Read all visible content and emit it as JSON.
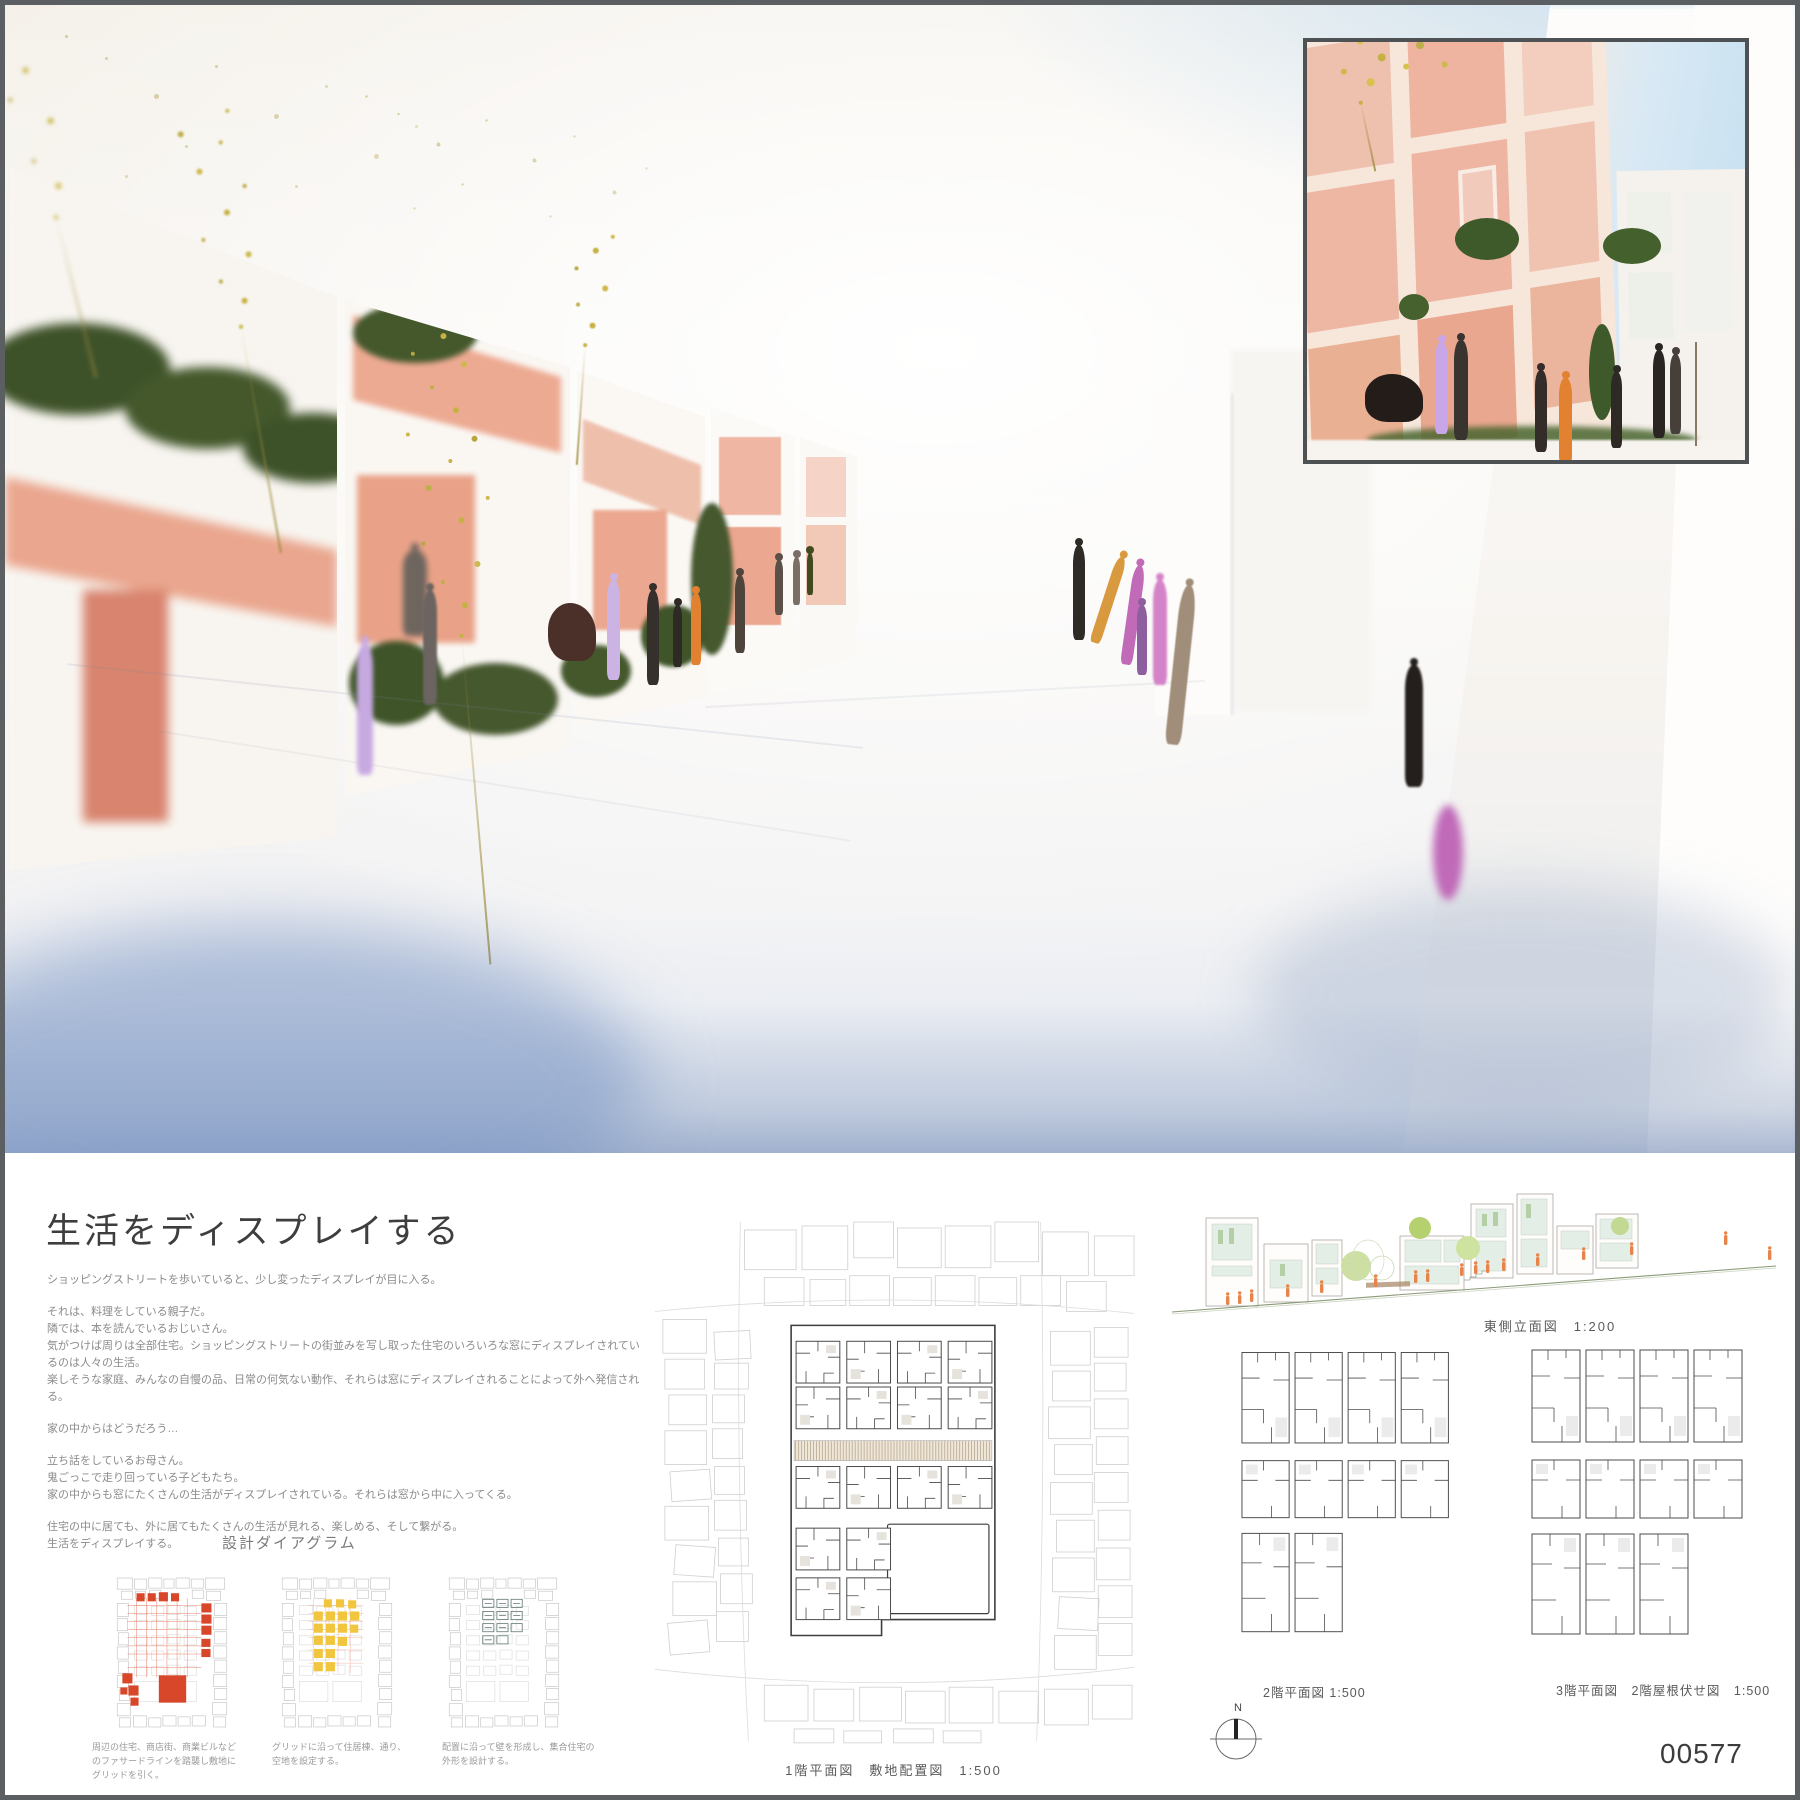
{
  "board": {
    "title": "生活をディスプレイする",
    "panel_number": "00577",
    "north_label": "N"
  },
  "intro": {
    "para1": [
      "ショッピングストリートを歩いていると、少し変ったディスプレイが目に入る。"
    ],
    "para2": [
      "それは、料理をしている親子だ。",
      "隣では、本を読んでいるおじいさん。",
      "気がつけば周りは全部住宅。ショッピングストリートの街並みを写し取った住宅のいろいろな窓にディスプレイされているのは人々の生活。",
      "楽しそうな家庭、みんなの自慢の品、日常の何気ない動作、それらは窓にディスプレイされることによって外へ発信される。"
    ],
    "para3": [
      "家の中からはどうだろう…"
    ],
    "para4": [
      "立ち話をしているお母さん。",
      "鬼ごっこで走り回っている子どもたち。",
      "家の中からも窓にたくさんの生活がディスプレイされている。それらは窓から中に入ってくる。"
    ],
    "para5": [
      "住宅の中に居ても、外に居てもたくさんの生活が見れる、楽しめる、そして繋がる。",
      "生活をディスプレイする。"
    ]
  },
  "diagrams": {
    "heading": "設計ダイアグラム",
    "items": [
      {
        "caption": "周辺の住宅、商店街、商業ビルなどのファサードラインを踏襲し敷地にグリッドを引く。"
      },
      {
        "caption": "グリッドに沿って住居棟、通り、空地を設定する。"
      },
      {
        "caption": "配置に沿って壁を形成し、集合住宅の外形を設計する。"
      }
    ],
    "accent_red": "#d9472b",
    "accent_yellow": "#f1c53d",
    "accent_teal": "#637875"
  },
  "drawings": {
    "site_plan_label": "1階平面図　敷地配置図　1:500",
    "elevation_label": "東側立面図　1:200",
    "plan2_label": "2階平面図 1:500",
    "plan3_label": "3階平面図　2階屋根伏せ図　1:500"
  },
  "photo": {
    "model_pink": "#eba78f",
    "figure_orange": "#e2812f",
    "figure_purple": "#c9a6e8",
    "greenery": "#3f5429"
  }
}
